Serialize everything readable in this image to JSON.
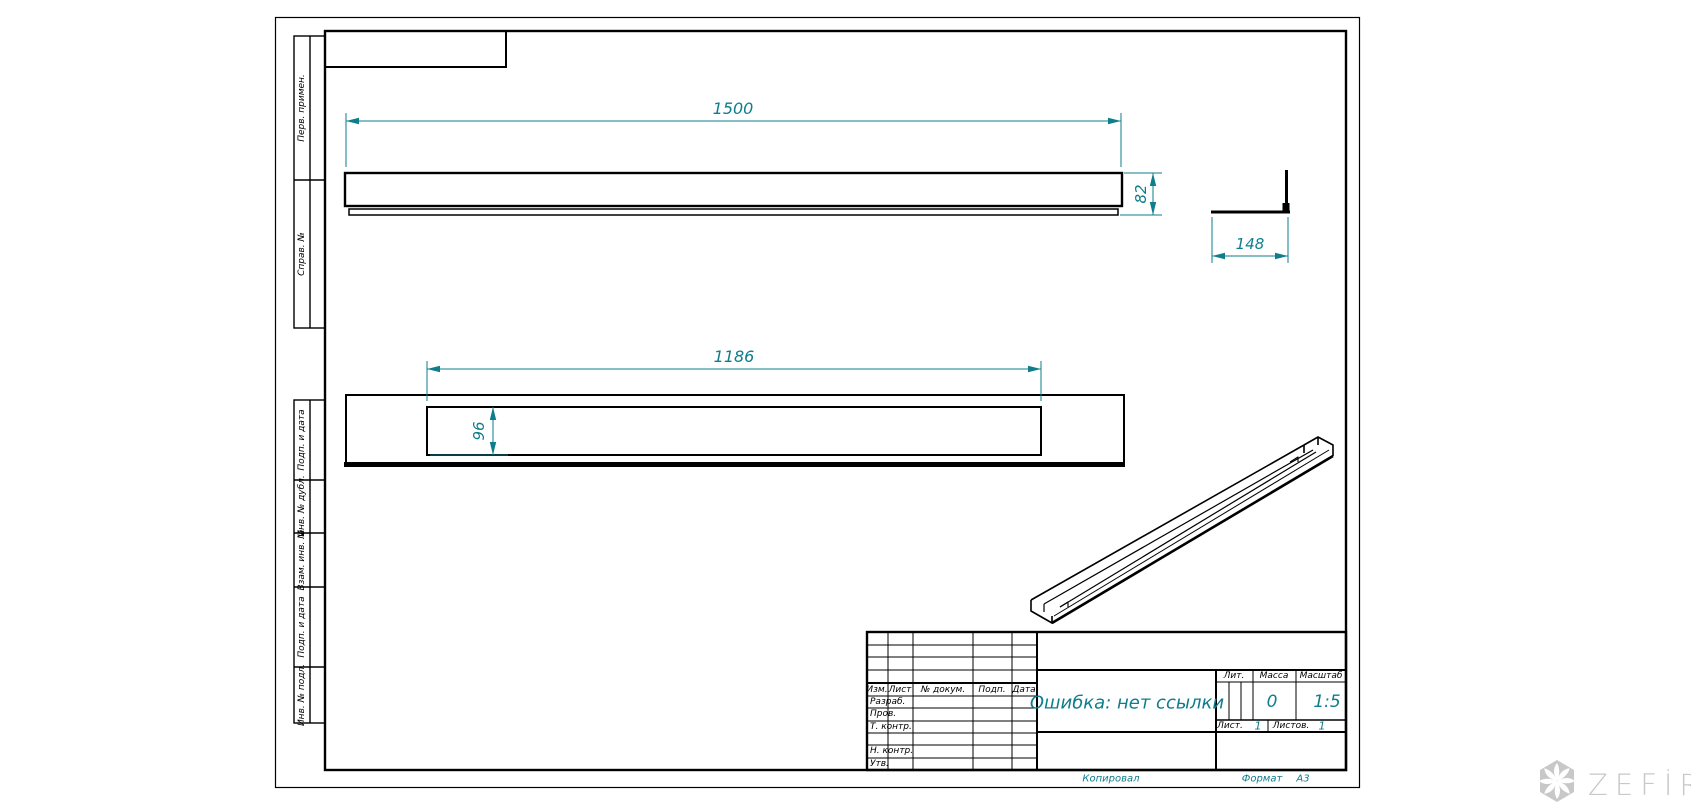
{
  "margin_labels": [
    "Перв. примен.",
    "Справ. №",
    "Подп. и дата",
    "Инв. № дубл.",
    "Взам. инв. №",
    "Подп. и дата",
    "Инв. № подл."
  ],
  "views": {
    "dim_top_length": "1500",
    "dim_top_height": "82",
    "dim_bracket_width": "148",
    "dim_mid_length": "1186",
    "dim_mid_depth": "96"
  },
  "title_block": {
    "change_cols": [
      "Изм.",
      "Лист",
      "№ докум.",
      "Подп.",
      "Дата"
    ],
    "sign_rows": [
      "Разраб.",
      "Пров.",
      "Т. контр.",
      "",
      "Н. контр.",
      "Утв."
    ],
    "doc_title": "Ошибка: нет ссылки",
    "lit_label": "Лит.",
    "mass_label": "Масса",
    "scale_label": "Масштаб",
    "mass_value": "0",
    "scale_value": "1:5",
    "sheet_label": "Лист.",
    "sheet_value": "1",
    "sheets_label": "Листов.",
    "sheets_value": "1",
    "copied": "Копировал",
    "format_label": "Формат",
    "format_value": "А3"
  },
  "watermark": {
    "text": "ZEFİRE"
  },
  "colors": {
    "dimension": "#0e7d8c",
    "line": "#000000",
    "watermark": "#c8c8c8"
  }
}
